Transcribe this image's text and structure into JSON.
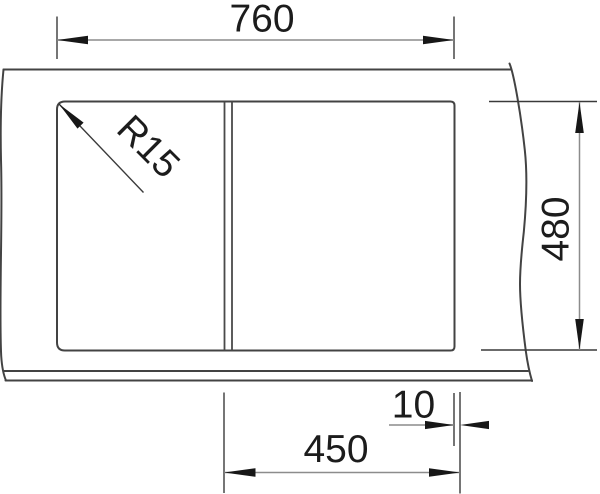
{
  "drawing": {
    "kind": "sink-plan-dimension-drawing",
    "dimensions": {
      "overall_width": {
        "label": "760"
      },
      "depth": {
        "label": "480"
      },
      "bowl_width": {
        "label": "450"
      },
      "edge_offset": {
        "label": "10"
      },
      "corner_radius": {
        "label": "R15"
      }
    },
    "colors": {
      "background": "#ffffff",
      "drawing_line": "#434343",
      "dimension_line": "#8c8c8c",
      "ink": "#1c1c1c"
    }
  }
}
